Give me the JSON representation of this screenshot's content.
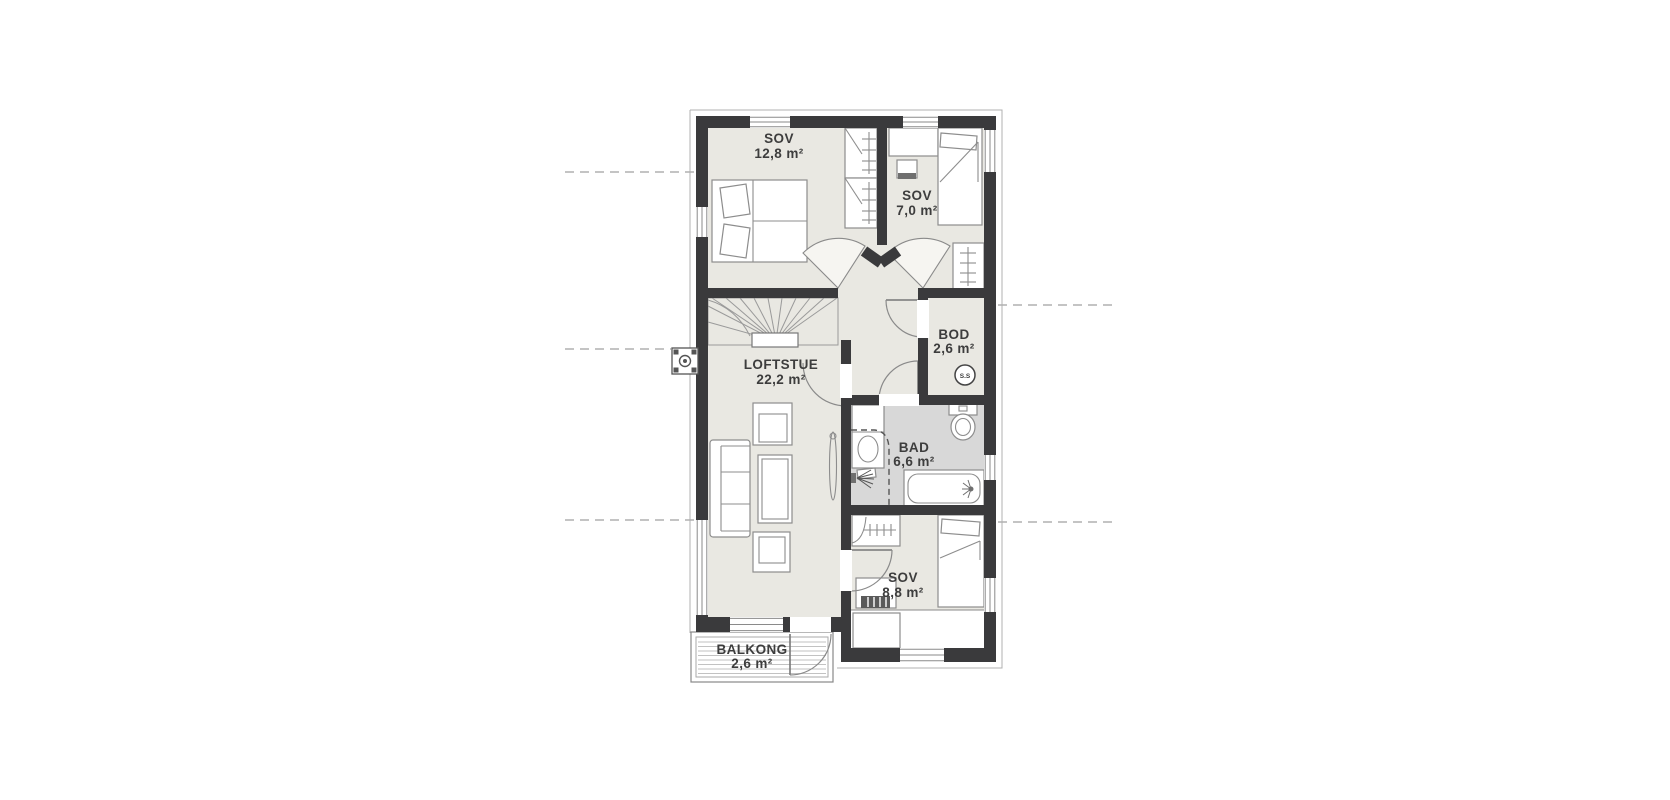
{
  "plan": {
    "rooms": [
      {
        "id": "sov1",
        "name": "SOV",
        "area": "12,8 m²"
      },
      {
        "id": "sov2",
        "name": "SOV",
        "area": "7,0 m²"
      },
      {
        "id": "bod",
        "name": "BOD",
        "area": "2,6 m²"
      },
      {
        "id": "loftstue",
        "name": "LOFTSTUE",
        "area": "22,2 m²"
      },
      {
        "id": "bad",
        "name": "BAD",
        "area": "6,6 m²"
      },
      {
        "id": "sov3",
        "name": "SOV",
        "area": "8,8 m²"
      },
      {
        "id": "balkong",
        "name": "BALKONG",
        "area": "2,6 m²"
      }
    ],
    "markers": {
      "ss_badge": "S.S"
    },
    "colors": {
      "wall": "#3a3a3c",
      "floor": "#e9e8e2",
      "bathroom_floor": "#d8d8d8",
      "background": "#ffffff"
    }
  }
}
